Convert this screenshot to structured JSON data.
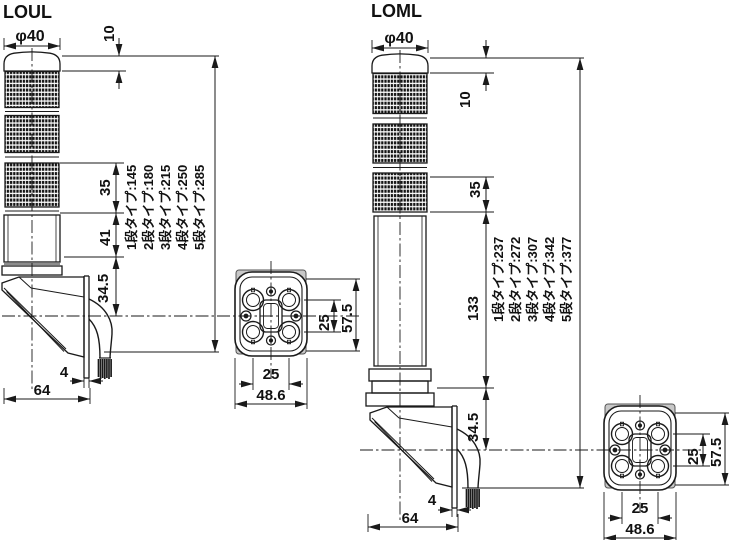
{
  "models": {
    "loul": {
      "name": "LOUL",
      "diameter": "φ40",
      "dim_cap": "10",
      "dim_lens": "35",
      "dim_body": "41",
      "dim_bracket": "34.5",
      "dim_plate": "4",
      "dim_depth": "64",
      "heights": [
        "1段タイプ:145",
        "2段タイプ:180",
        "3段タイプ:215",
        "4段タイプ:250",
        "5段タイプ:285"
      ]
    },
    "loml": {
      "name": "LOML",
      "diameter": "φ40",
      "dim_cap": "10",
      "dim_lens": "35",
      "dim_pole": "133",
      "dim_bracket": "34.5",
      "dim_plate": "4",
      "dim_depth": "64",
      "heights": [
        "1段タイプ:237",
        "2段タイプ:272",
        "3段タイプ:307",
        "4段タイプ:342",
        "5段タイプ:377"
      ]
    },
    "flange": {
      "pitch_v": "25",
      "height": "57.5",
      "pitch_h": "25",
      "width": "48.6"
    },
    "colors": {
      "line": "#1a1a1a",
      "gray_fill": "#c8c8c8"
    }
  }
}
